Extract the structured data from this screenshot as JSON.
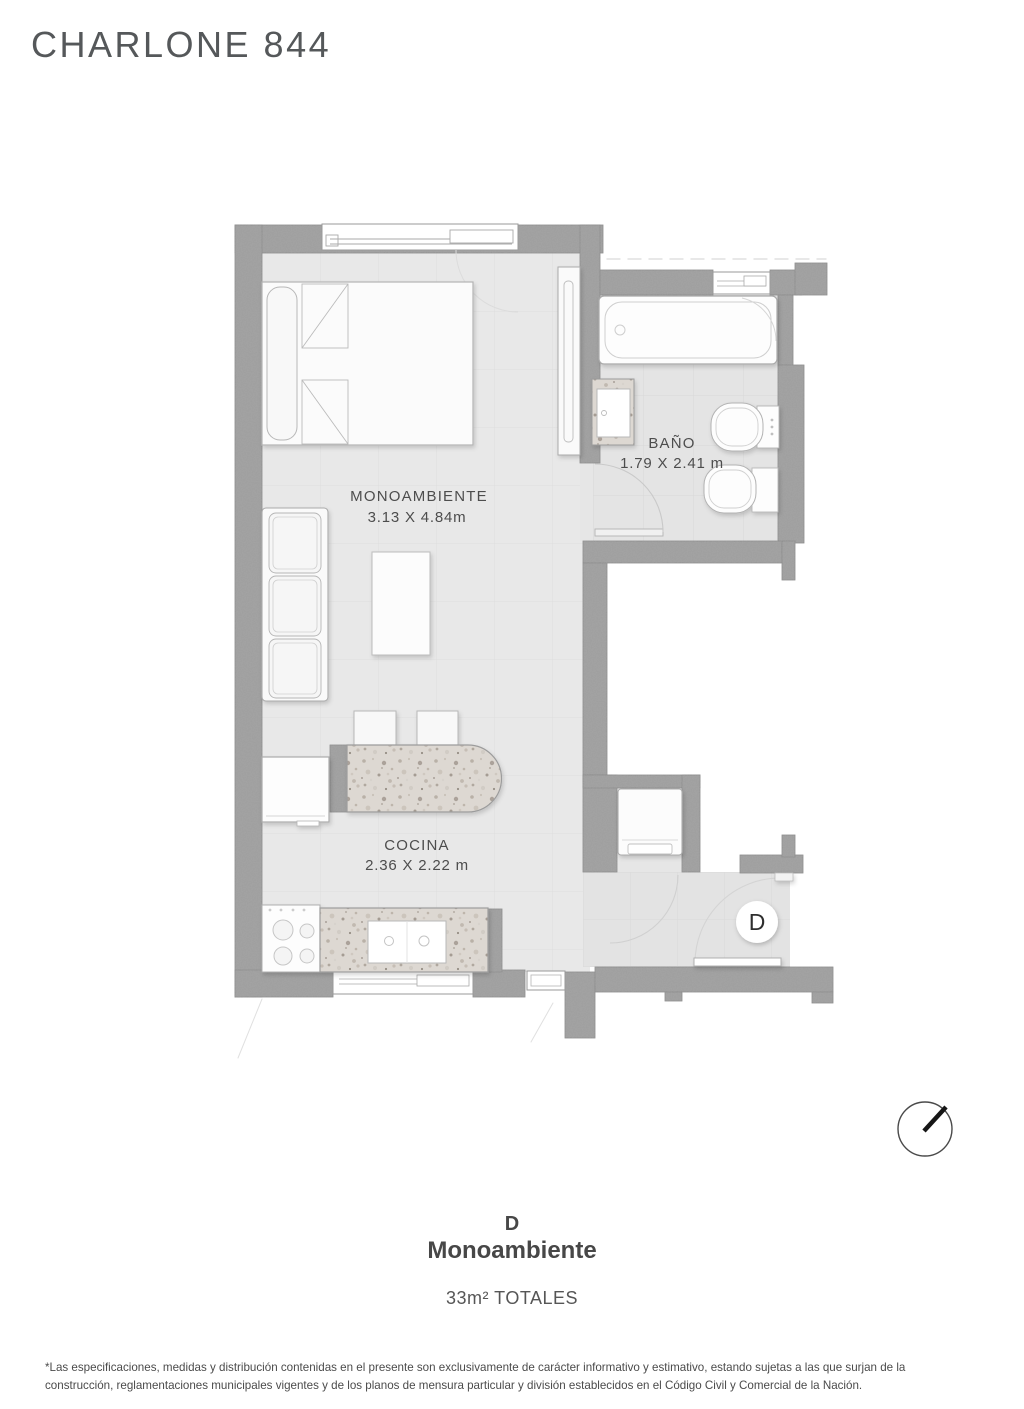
{
  "header": {
    "title": "CHARLONE 844"
  },
  "plan": {
    "rooms": {
      "monoambiente": {
        "label": "MONOAMBIENTE",
        "dims": "3.13 X 4.84m"
      },
      "bano": {
        "label": "BAÑO",
        "dims": "1.79 X 2.41 m"
      },
      "cocina": {
        "label": "COCINA",
        "dims": "2.36 X 2.22 m"
      }
    },
    "unit_marker": "D"
  },
  "footer": {
    "unit_letter": "D",
    "unit_type": "Monoambiente",
    "total_area": "33m² TOTALES"
  },
  "disclaimer": "*Las especificaciones, medidas y distribución contenidas en el presente son exclusivamente de carácter informativo y estimativo, estando sujetas a las que surjan de la construcción, reglamentaciones municipales vigentes y de los planos de mensura particular y división establecidos en el Código Civil y Comercial de la Nación.",
  "colors": {
    "wall": "#9e9e9e",
    "floor": "#e8e8e8",
    "terrazzo_base": "#ddd8d2",
    "text": "#4d4d4d"
  }
}
